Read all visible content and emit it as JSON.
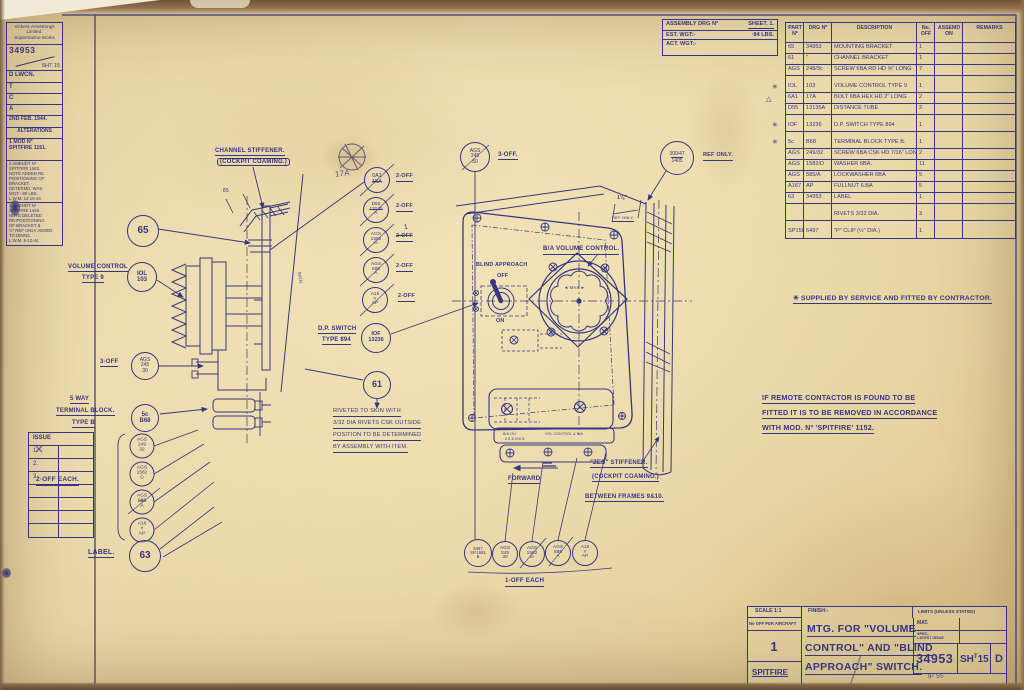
{
  "colors": {
    "ink": "#343781",
    "paper": "#e9d5a4"
  },
  "corner_block": {
    "company": "Vickers-Armstrongs\nLimited.\nSupermarine Works",
    "drg_no": "34953",
    "sheet_no": "SHT 15",
    "sig_1": "D LWCN.",
    "sig_2": "T",
    "sig_3": "C",
    "sig_4": "A",
    "date": "2ND FEB. 1944.",
    "alterations": "ALTERATIONS",
    "alt1": "1 MOD Nº\nSPITFIRE 1151.",
    "alt2": "2 AMENDT Nº\nSPITFIRE 1582.\nNOTE ADDED RE\nPOSITIONING OF\nBRACKET.\nDETERMD. WAS\nWGT. ·85 LBS.\nL.W.M. 12-10-44",
    "alt3": "3 AMENDT Nº\nSPITFIRE 1440.\nNOTE DELETED\nRE-POSITIONING\nOF BRACKET &\n½\" REF ONLY ADDED\nTO DIMNS.\nL.W.M. 5-12-44"
  },
  "issue_block": {
    "heading": "ISSUE",
    "r1": "1.",
    "r2": "2.",
    "r3": "3."
  },
  "assembly_header": {
    "line1a": "ASSEMBLY DRG Nº",
    "line1b": "SHEET. 1.",
    "line2a": "EST. WGT:-",
    "line2b": "·84 LBS.",
    "line3a": "ACT. WGT:-"
  },
  "parts_table": {
    "headers": {
      "part": "PART\nNº",
      "drg": "DRG Nº",
      "desc": "DESCRIPTION",
      "off": "No.\nOFF",
      "asm": "ASSEMD\nON",
      "remarks": "REMARKS"
    },
    "markers": {
      "m1": "✳",
      "m2": "△",
      "m3": "✳",
      "m4": "✳"
    },
    "rows": [
      {
        "part": "65",
        "drg": "34953",
        "desc": "MOUNTING BRACKET",
        "off": "1"
      },
      {
        "part": "61",
        "drg": "\"",
        "desc": "CHANNEL BRACKET",
        "off": "1"
      },
      {
        "part": "AGS",
        "drg": "248/3c",
        "desc": "SCREW 6BA RD HD ⅝\" LONG",
        "off": "7"
      },
      {
        "spacer": true
      },
      {
        "part": "IOL",
        "drg": "103",
        "desc": "VOLUME CONTROL TYPE 9",
        "off": "1"
      },
      {
        "part": "6A1",
        "drg": "17A",
        "desc": "BOLT 6BA HEX HD 2\" LONG",
        "off": "2"
      },
      {
        "part": "D55",
        "drg": "13135A",
        "desc": "DISTANCE TUBE",
        "off": "2"
      },
      {
        "spacer": true
      },
      {
        "part": "IOF",
        "drg": "13236",
        "desc": "D.P. SWITCH TYPE 894",
        "off": "1"
      },
      {
        "spacer": true
      },
      {
        "part": "5c",
        "drg": "B68",
        "desc": "TERMINAL BLOCK TYPE B.",
        "off": "1"
      },
      {
        "part": "AGS",
        "drg": "249/32",
        "desc": "SCREW 6BA CSK HD 7/16\" LONG",
        "off": "2"
      },
      {
        "part": "AGS",
        "drg": "1582/D",
        "desc": "WASHER 6BA.",
        "off": "11"
      },
      {
        "part": "AGS",
        "drg": "585/A",
        "desc": "LOCKWASHER 6BA",
        "off": "5"
      },
      {
        "part": "A167",
        "drg": "AP",
        "desc": "FULLNUT 6.BA",
        "off": "5"
      },
      {
        "part": "63",
        "drg": "34953",
        "desc": "LABEL",
        "off": "1"
      },
      {
        "spacer": true
      },
      {
        "part": "",
        "drg": "",
        "desc": "RIVETS 3/32 DIA.",
        "off": "3"
      },
      {
        "spacer": true
      },
      {
        "part": "SP1581",
        "drg": "6497",
        "desc": "\"P\" CLIP (½\" DIA.)",
        "off": "1"
      }
    ]
  },
  "notes": {
    "supplied": "✳ SUPPLIED BY SERVICE AND FITTED BY CONTRACTOR.",
    "remote1": "IF REMOTE CONTACTOR IS FOUND TO BE",
    "remote2": "FITTED IT IS TO BE REMOVED IN ACCORDANCE",
    "remote3": "WITH MOD. Nº 'SPITFIRE' 1152.",
    "riveted1": "RIVETED TO SKIN WITH",
    "riveted2": "3/32 DIA RIVETS CSK OUTSIDE",
    "riveted3": "POSITION TO BE DETERMINED",
    "riveted4": "BY ASSEMBLY WITH ITEM."
  },
  "labels": {
    "channel_stiffener1": "CHANNEL STIFFENER.",
    "channel_stiffener2": "(COCKPIT COAMING.)",
    "volume_control1": "VOLUME CONTROL",
    "volume_control2": "TYPE 9",
    "dp_switch1": "D.P. SWITCH",
    "dp_switch2": "TYPE 894",
    "five_way1": "5 WAY",
    "five_way2": "TERMINAL BLOCK.",
    "five_way3": "TYPE B",
    "two_off": "2-OFF",
    "two_off_each": "2·OFF EACH.",
    "three_off": "3-OFF",
    "three_off_dot": "3-OFF.",
    "one_off_each": "1-OFF EACH",
    "label_word": "LABEL.",
    "ba_volume": "B/A VOLUME CONTROL.",
    "blind_approach": "BLIND APPROACH",
    "off": "OFF",
    "on": "ON",
    "max": "◄ MAX ►",
    "skin": "SKIN.",
    "dim_85": "·85",
    "dim_118": "1⅛\"",
    "ref_only_dim": "REF ONLY.",
    "ref_only": "REF ONLY.",
    "zed1": "\"ZED\" STIFFENER.",
    "zed2": "(COCKPIT COAMING.)",
    "zed3": "BETWEEN FRAMES 9&10.",
    "forward": "FORWARD",
    "hand_17a": "17A",
    "hand_1": "1",
    "strip_left": "B/A ON",
    "strip_right": "VOL CONTROL & B/A",
    "strip_letters": "A     B        B     M/A     B"
  },
  "balloons": {
    "b65": "65",
    "b61": "61",
    "b63": "63",
    "iol": "IOL\n103",
    "iof": "IOF\n13236",
    "c5": "5c\nB68",
    "a6a1_top": "6A1",
    "a6a1_bot": "15A",
    "d55_top": "D55",
    "d55_mid": "13135",
    "d55_bot": "A",
    "m1582": "AGS\n1582\nD",
    "m585": "AGS\n585\nA",
    "ma16": "A16\nY\nAP",
    "l245": "AGS\n245\n30",
    "l249": "AGS\n249\n32",
    "l1582": "AGS\n1582\nD",
    "l585_top": "AGS",
    "l585_mid": "585",
    "l585_bot": "A",
    "la16": "A16\nY\nAP",
    "t245": "AGS\n245\n50",
    "b300a": "300/47",
    "b300b": "1405",
    "p6497": "6497\nSP.1581\nB",
    "q245": "AGS\n245\n30",
    "q1582": "AGS\n1582\nD",
    "q585": "AGS\n585\nA",
    "qa16": "A16\nY\nAP"
  },
  "title_block": {
    "scale": "SCALE 1:1",
    "finish": "FINISH:-",
    "limits": "LIMITS (UNLESS STATED)",
    "no_off_heading": "No OFF PER AIRCRAFT",
    "no_off": "1",
    "aircraft": "SPITFIRE",
    "title1": "MTG. FOR \"VOLUME",
    "title2": "CONTROL\" AND \"BLIND",
    "title3": "APPROACH\" SWITCH.",
    "mat": "MAT.",
    "spec": "SPEC-\nLATEST ISSUE",
    "drg_no": "34953",
    "sheet_a": "SH",
    "sheet_b": "T",
    "sheet_c": "15",
    "rev": "D",
    "hand": "9² 55"
  }
}
